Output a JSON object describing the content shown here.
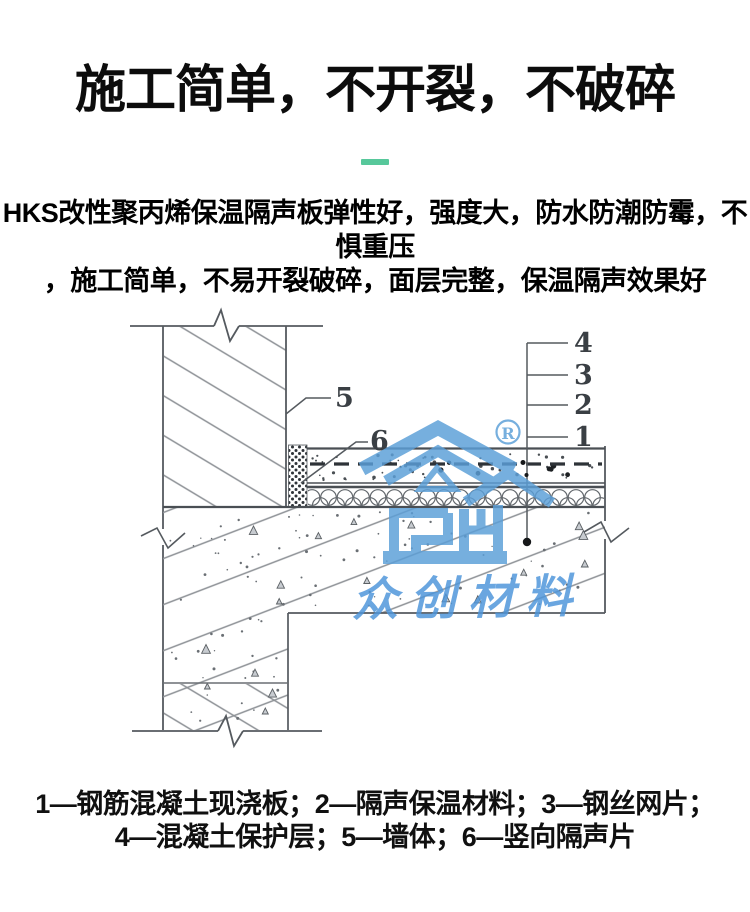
{
  "page": {
    "background": "#ffffff"
  },
  "header": {
    "title": "施工简单，不开裂，不破碎",
    "divider_color": "#57c89b",
    "description_line1": "HKS改性聚丙烯保温隔声板弹性好，强度大，防水防潮防霉，不惧重压",
    "description_line2": "，施工简单，不易开裂破碎，面层完整，保温隔声效果好"
  },
  "diagram": {
    "callout_numbers": {
      "c1": "1",
      "c2": "2",
      "c3": "3",
      "c4": "4",
      "c5": "5",
      "c6": "6"
    },
    "watermark": {
      "brand_text": "众创材料",
      "registered_mark": "R",
      "color": "#5b9fd8"
    }
  },
  "legend": {
    "line1": "1—钢筋混凝土现浇板；2—隔声保温材料；3—钢丝网片；",
    "line2": "4—混凝土保护层；5—墙体；6—竖向隔声片"
  }
}
